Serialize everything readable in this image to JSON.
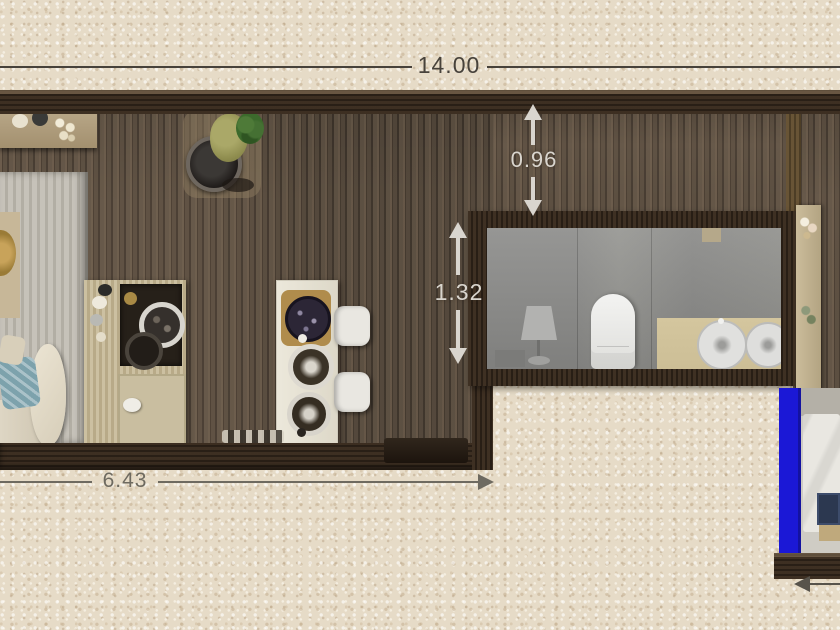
{
  "annotations": {
    "total_width": "14.00",
    "hall_depth": "0.96",
    "bath_depth": "1.32",
    "living_width": "6.43"
  },
  "colors": {
    "background": "#e6dbc7",
    "wall-dark": "#33271c",
    "floor-wood": "#5e5144",
    "rug": "#c6c2b9",
    "bath-floor": "#8d8d8a",
    "vanity-top": "#ccbe96",
    "selection-blue": "#1b18d6",
    "dim-dark": "#47423b",
    "dim-light": "#d9d5ce",
    "dim-gray": "#6e6a60"
  }
}
